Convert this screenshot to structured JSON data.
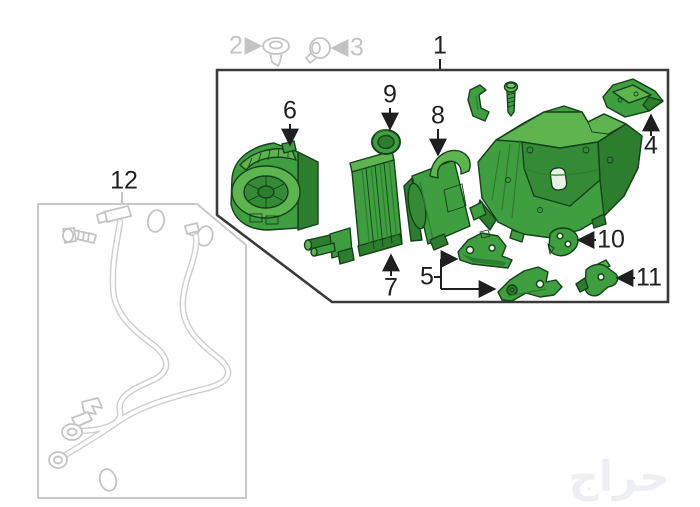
{
  "canvas": {
    "width": 700,
    "height": 507
  },
  "callouts": {
    "c1": {
      "label": "1"
    },
    "c2": {
      "label": "2"
    },
    "c3": {
      "label": "3"
    },
    "c4": {
      "label": "4"
    },
    "c5": {
      "label": "5"
    },
    "c6": {
      "label": "6"
    },
    "c7": {
      "label": "7"
    },
    "c8": {
      "label": "8"
    },
    "c9": {
      "label": "9"
    },
    "c10": {
      "label": "10"
    },
    "c11": {
      "label": "11"
    },
    "c12": {
      "label": "12"
    }
  },
  "watermark": {
    "text": "حراج"
  },
  "icons": {
    "fastener_2": "grommet-icon",
    "fastener_3": "push-pin-icon"
  },
  "colors": {
    "background": "#ffffff",
    "callout_text": "#1f1f1f",
    "muted": "#c4c4c4",
    "assembly_box_border": "#3a3a3a",
    "hose_box_border": "#c9c9c9",
    "hose_line": "#cfcfcf",
    "part_fill": "#3f9e3f",
    "part_fill_light": "#5eb54f",
    "part_fill_lighter": "#79c465",
    "part_fill_dark": "#2d7d2e",
    "part_recess": "#358b35",
    "part_hole": "#eaf4e6",
    "part_outline": "#14421a",
    "watermark": "#edeff2"
  }
}
